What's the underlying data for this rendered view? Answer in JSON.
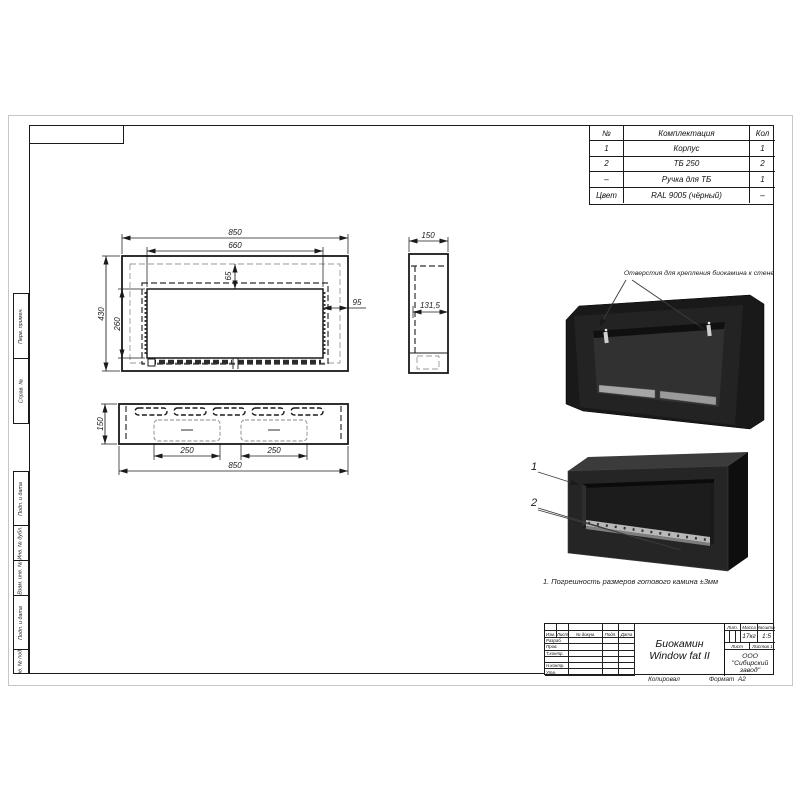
{
  "comp_table": {
    "headers": [
      "№",
      "Комплектация",
      "Кол"
    ],
    "rows": [
      [
        "1",
        "Корпус",
        "1"
      ],
      [
        "2",
        "ТБ 250",
        "2"
      ],
      [
        "–",
        "Ручка для ТБ",
        "1"
      ],
      [
        "Цвет",
        "RAL 9005 (чёрный)",
        "–"
      ]
    ]
  },
  "dims": {
    "front_width": "850",
    "front_opening_width": "660",
    "front_height": "430",
    "front_opening_height": "260",
    "front_top_inset": "65",
    "front_side_inset": "95",
    "side_depth": "150",
    "side_inner": "131,5",
    "bottom_depth": "150",
    "bottom_slot_left": "250",
    "bottom_slot_right": "250",
    "bottom_width": "850"
  },
  "annotations": {
    "mounting": "Отверстия для крепления биокамина к стене",
    "note": "1. Погрешность размеров готового камина ±3мм",
    "callout1": "1",
    "callout2": "2"
  },
  "title_block": {
    "name_line1": "Биокамин",
    "name_line2": "Window fat II",
    "columns": [
      "Изм.",
      "Лист",
      "№ докум.",
      "Подп.",
      "Дата"
    ],
    "rows": [
      "Разраб.",
      "Пров.",
      "Т.контр.",
      "Н.контр.",
      "Утв."
    ],
    "lit_label": "Лит.",
    "mass_label": "Масса",
    "scale_label": "Масштаб",
    "mass_value": "17кг",
    "scale_value": "1:5",
    "sheet_label": "Лист",
    "sheets_label": "Листов",
    "sheets_value": "1",
    "company": "ООО \"Сибирский завод\"",
    "copied": "Копировал",
    "format_label": "Формат",
    "format_value": "А2"
  },
  "margin_stamps": [
    "Перв. примен.",
    "Справ. №",
    "Подп. и дата",
    "Инв. № дубл.",
    "Взам. инв. №",
    "Подп. и дата",
    "Инв. № подл."
  ],
  "colors": {
    "line": "#1a1a1a",
    "fireplace_body": "#232323",
    "fireplace_side": "#0e0e0e",
    "metal_strip": "#b5b5b5"
  }
}
